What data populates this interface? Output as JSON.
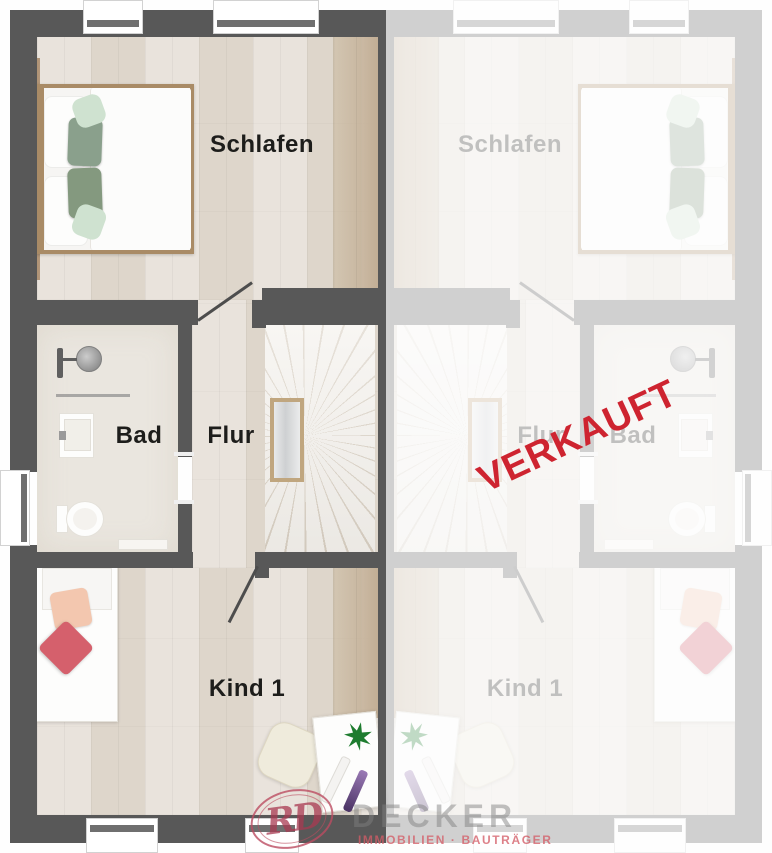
{
  "plan": {
    "unit_left": {
      "room_labels": {
        "bedroom": "Schlafen",
        "bath": "Bad",
        "hall": "Flur",
        "child": "Kind 1"
      }
    },
    "unit_right": {
      "sold_stamp": "VERKAUFT",
      "room_labels": {
        "bedroom": "Schlafen",
        "bath": "Bad",
        "hall": "Flur",
        "child": "Kind 1"
      }
    }
  },
  "branding": {
    "monogram": "RD",
    "company": "DECKER",
    "tagline": "IMMOBILIEN · BAUTRÄGER"
  },
  "colors": {
    "wall": "#585858",
    "stamp_red": "#ce2430",
    "wood": "#e7e1d9",
    "wood_accent": "#c2ae95",
    "tile": "#eae6df",
    "logo_pink": "#bc4c61"
  }
}
